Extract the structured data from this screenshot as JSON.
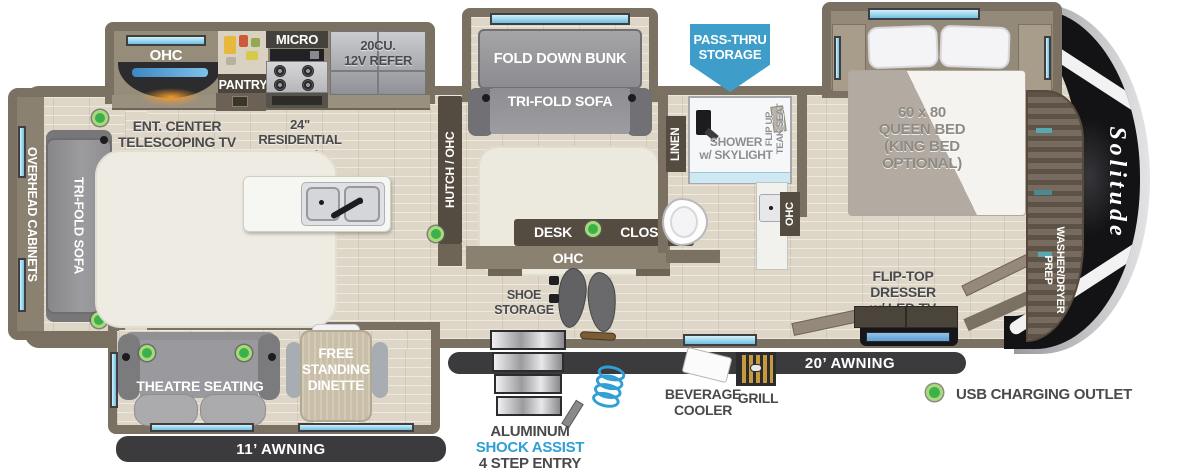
{
  "brand": {
    "logo": "Solitude"
  },
  "colors": {
    "wall": "#7b7163",
    "floor": "#ded7c8",
    "accent_blue": "#3f9ec9",
    "usb_green": "#3cb14b",
    "awning_dark": "#3b3b3d",
    "shock_assist_blue": "#2f9fd6",
    "cap_black": "#131316"
  },
  "labels": {
    "overhead_cabinets": "OVERHEAD CABINETS",
    "rear_sofa": "TRI-FOLD SOFA",
    "ohc_kitchen": "OHC",
    "pantry": "PANTRY",
    "micro": "MICRO",
    "refer_1": "20CU.",
    "refer_2": "12V REFER",
    "ent_center_1": "ENT. CENTER",
    "ent_center_2": "TELESCOPING TV",
    "ent_center_3": "w/ FIREPLACE",
    "oven_1": "24\" RESIDENTIAL",
    "oven_2": "OVEN",
    "hutch": "HUTCH / OHC",
    "fold_down_bunk": "FOLD DOWN BUNK",
    "bunk_sofa": "TRI-FOLD SOFA",
    "desk": "DESK",
    "closet": "CLOSET",
    "ohc_bunk": "OHC",
    "shoe_1": "SHOE",
    "shoe_2": "STORAGE",
    "pass_thru_1": "PASS-THRU",
    "pass_thru_2": "STORAGE",
    "linen": "LINEN",
    "shower_1": "SHOWER",
    "shower_2": "w/ SKYLIGHT",
    "teak_1": "FLIP UP",
    "teak_2": "TEAK SEAT",
    "ohc_bath": "OHC",
    "bed_1": "60 x 80",
    "bed_2": "QUEEN BED",
    "bed_3": "(KING BED",
    "bed_4": "OPTIONAL)",
    "dresser_1": "FLIP-TOP DRESSER",
    "dresser_2": "w/ LED TV",
    "washer_1": "WASHER/DRYER",
    "washer_2": "PREP",
    "theatre": "THEATRE SEATING",
    "dinette_1": "FREE",
    "dinette_2": "STANDING",
    "dinette_3": "DINETTE",
    "awning_rear": "11’ AWNING",
    "awning_main": "20’ AWNING",
    "steps_1": "ALUMINUM",
    "steps_2": "SHOCK ASSIST",
    "steps_3": "4 STEP ENTRY",
    "bev_1": "BEVERAGE",
    "bev_2": "COOLER",
    "grill": "GRILL",
    "legend_usb": "USB CHARGING OUTLET"
  }
}
